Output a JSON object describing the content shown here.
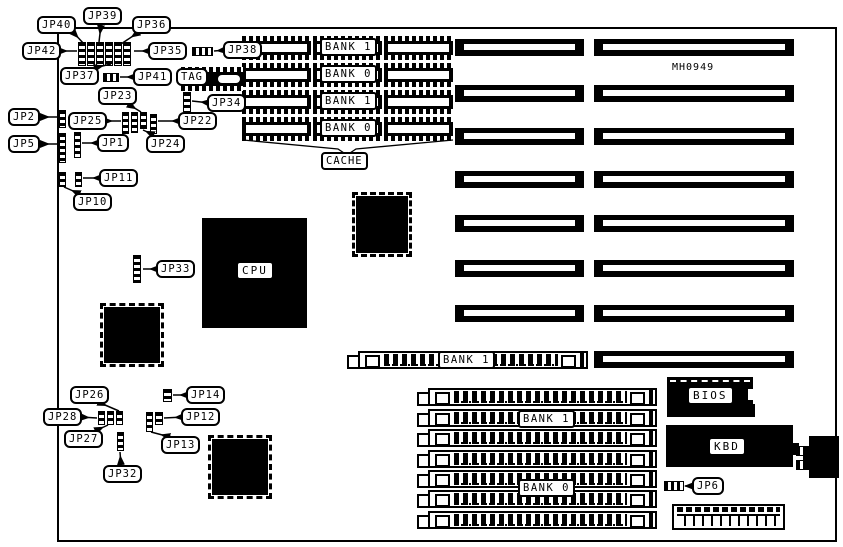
{
  "board": {
    "part_number": "MH0949"
  },
  "jumpers": {
    "jp1": "JP1",
    "jp2": "JP2",
    "jp5": "JP5",
    "jp6": "JP6",
    "jp10": "JP10",
    "jp11": "JP11",
    "jp12": "JP12",
    "jp13": "JP13",
    "jp14": "JP14",
    "jp22": "JP22",
    "jp23": "JP23",
    "jp24": "JP24",
    "jp25": "JP25",
    "jp26": "JP26",
    "jp27": "JP27",
    "jp28": "JP28",
    "jp32": "JP32",
    "jp33": "JP33",
    "jp34": "JP34",
    "jp35": "JP35",
    "jp36": "JP36",
    "jp37": "JP37",
    "jp38": "JP38",
    "jp39": "JP39",
    "jp40": "JP40",
    "jp41": "JP41",
    "jp42": "JP42"
  },
  "components": {
    "cpu": "CPU",
    "tag": "TAG",
    "bios": "BIOS",
    "kbd": "KBD",
    "cache": "CACHE"
  },
  "memory": {
    "cache_banks": [
      "BANK 1",
      "BANK 0",
      "BANK 1",
      "BANK 0"
    ],
    "simm_top": "BANK 1",
    "simm_bank1": "BANK 1",
    "simm_bank0": "BANK 0"
  }
}
